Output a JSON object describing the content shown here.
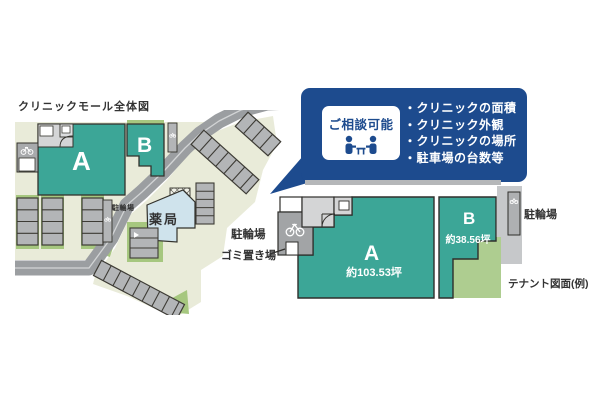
{
  "page": {
    "background": "#ffffff"
  },
  "colors": {
    "navy": "#1d4b8e",
    "teal": "#3ca697",
    "site_ground": "#e9ebd9",
    "road_gray": "#9b9ea1",
    "green": "#a6c77f",
    "green_light": "#aecd90",
    "pharmacy_blue": "#cfe3ec",
    "outline_dark": "#33322c"
  },
  "site_map": {
    "title": "クリニックモール全体図",
    "unit_a_label": "A",
    "unit_b_label": "B",
    "bicycle_parking_label": "駐輪場",
    "pharmacy_label": "薬局"
  },
  "callout": {
    "badge_label": "ご相談可能",
    "items": [
      "・クリニックの面積",
      "・クリニック外観",
      "・クリニックの場所",
      "・駐車場の台数等"
    ]
  },
  "tenant_plan": {
    "caption": "テナント図面(例)",
    "unit_a_label": "A",
    "unit_a_area": "約103.53坪",
    "unit_b_label": "B",
    "unit_b_area": "約38.56坪",
    "bicycle_parking_left_label": "駐輪場",
    "garbage_area_label": "ゴミ置き場",
    "bicycle_parking_right_label": "駐輪場"
  }
}
